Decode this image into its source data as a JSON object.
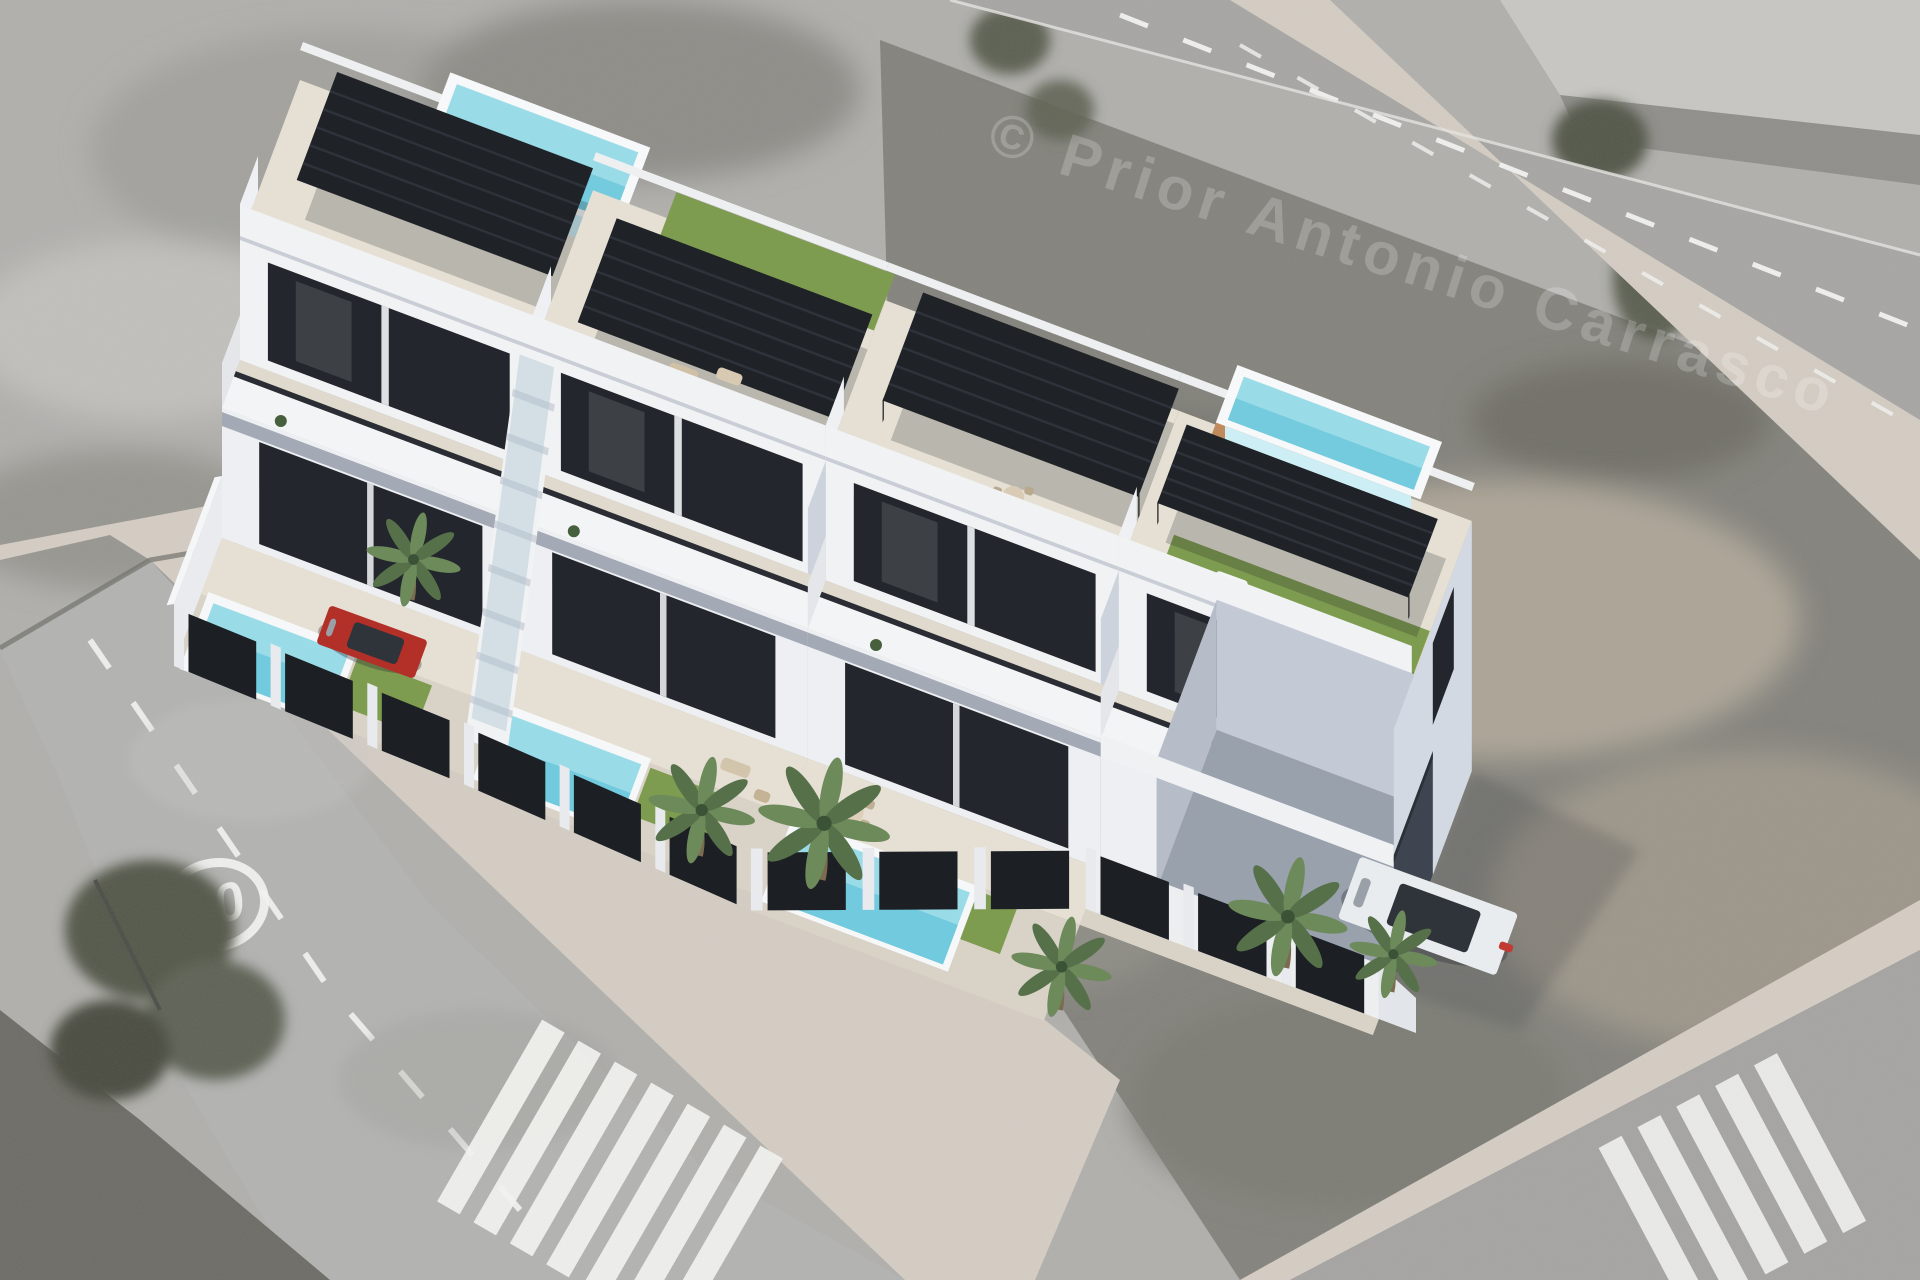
{
  "scene": {
    "description": "Aerial 3D architectural render of a row of four modern white townhouses with rooftop solariums, black louvered pergolas, rooftop plunge pools, artificial-turf terraces, private garden pools, palm trees and a corner carport, composited onto a grayscale aerial photo with streets, crosswalks and vacant lots",
    "watermark_text": "© Prior Antonio Carrasco",
    "road_speed_marking": "20",
    "units_visible": 4
  },
  "palette": {
    "ground": "#b1b0ad",
    "scrub": "#83827c",
    "scrub_dark": "#6b6a64",
    "sand": "#b5ab9c",
    "asphalt": "#b3b3b1",
    "asphalt_top": "#a7a6a4",
    "sidewalk": "#d6cec5",
    "marking": "#f6f6f4",
    "building_white": "#f1f2f4",
    "building_top": "#e7e1d5",
    "building_shade": "#cdd3dd",
    "building_deep": "#9aa2b0",
    "glass": "#23272d",
    "pergola": "#1f2227",
    "pergola_slat": "#3a404a",
    "pool": "#9adbe8",
    "pool_deep": "#5fc3d8",
    "pool_pale": "#cdeef5",
    "turf": "#7e9c50",
    "turf_dark": "#6b8a41",
    "wood": "#c08a5c",
    "terrace": "#e6e0d4",
    "fence": "#1c1f23",
    "car_white": "#e9ecef",
    "car_red": "#b23028",
    "tree_green": "#515447",
    "palm_green": "#567149",
    "palm_light": "#6d8a5b",
    "trunk": "#7b6b50"
  },
  "elements": [
    "rooftop-pergola",
    "rooftop-pool",
    "rooftop-turf-terrace",
    "roof-terrace",
    "balcony",
    "garden-pool",
    "garden-fence",
    "palm-tree",
    "exterior-stairway",
    "carport",
    "white-car",
    "red-car",
    "crosswalk",
    "speed-limit-road-marking",
    "construction-lot",
    "vacant-scrub-lot"
  ]
}
